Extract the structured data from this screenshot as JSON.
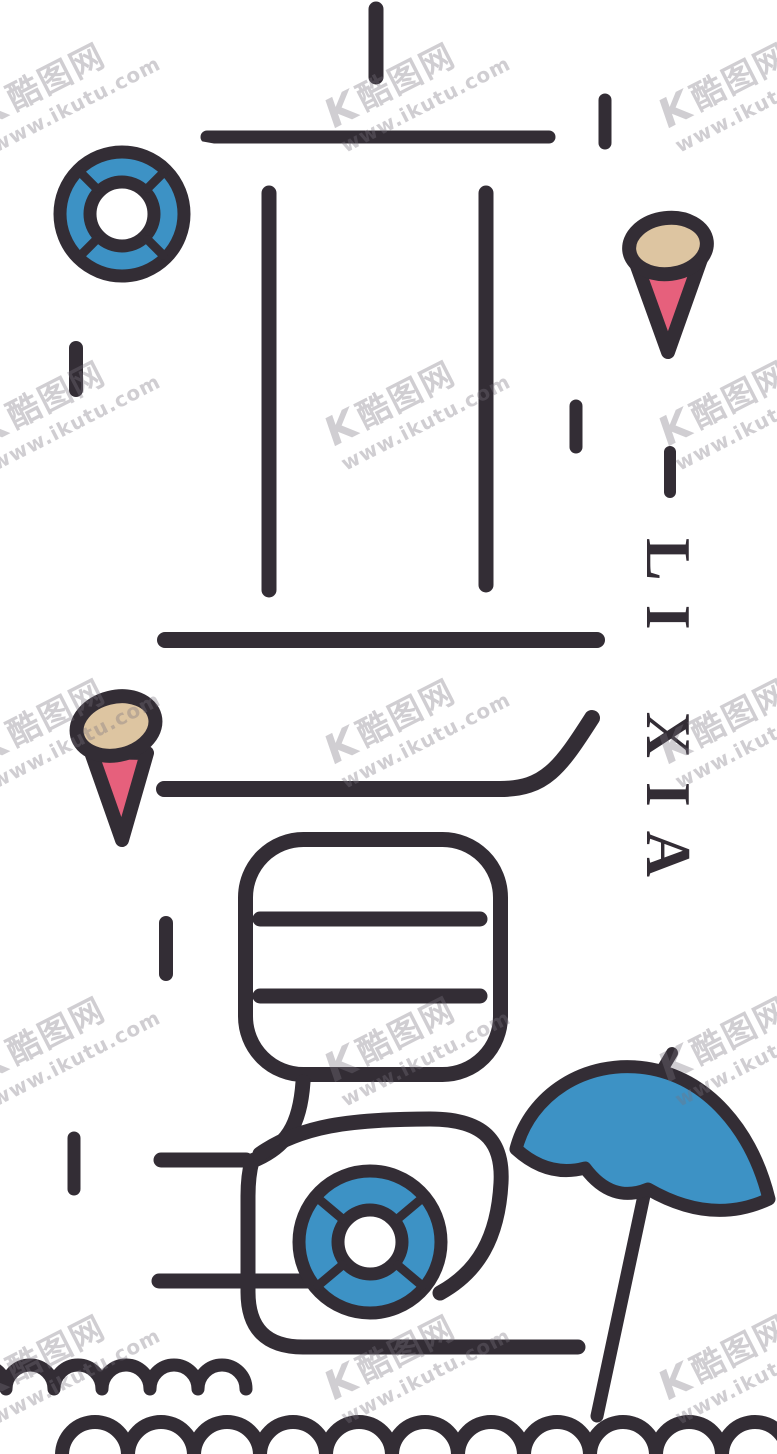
{
  "artwork": {
    "title_vertical": "LI XIA"
  },
  "watermark": {
    "logo": "K",
    "brand": "酷图网",
    "url": "www.ikutu.com"
  },
  "colors": {
    "ink": "#332d35",
    "blue": "#3d92c5",
    "cream": "#ddc5a1",
    "pink": "#e6607c",
    "watermark": "rgba(120,115,125,0.35)",
    "background": "#ffffff"
  },
  "elements": {
    "lifebuoy_top": "blue lifebuoy ring, upper left",
    "lifebuoy_bottom": "blue lifebuoy ring inside bottom shape",
    "ice_cream_left": "ice cream cone, middle left",
    "ice_cream_right": "ice cream cone, upper right",
    "umbrella": "blue beach umbrella, bottom right",
    "waves": "two rows of scalloped waves, bottom",
    "character_strokes": "stylized Chinese character strokes forming 夏"
  }
}
